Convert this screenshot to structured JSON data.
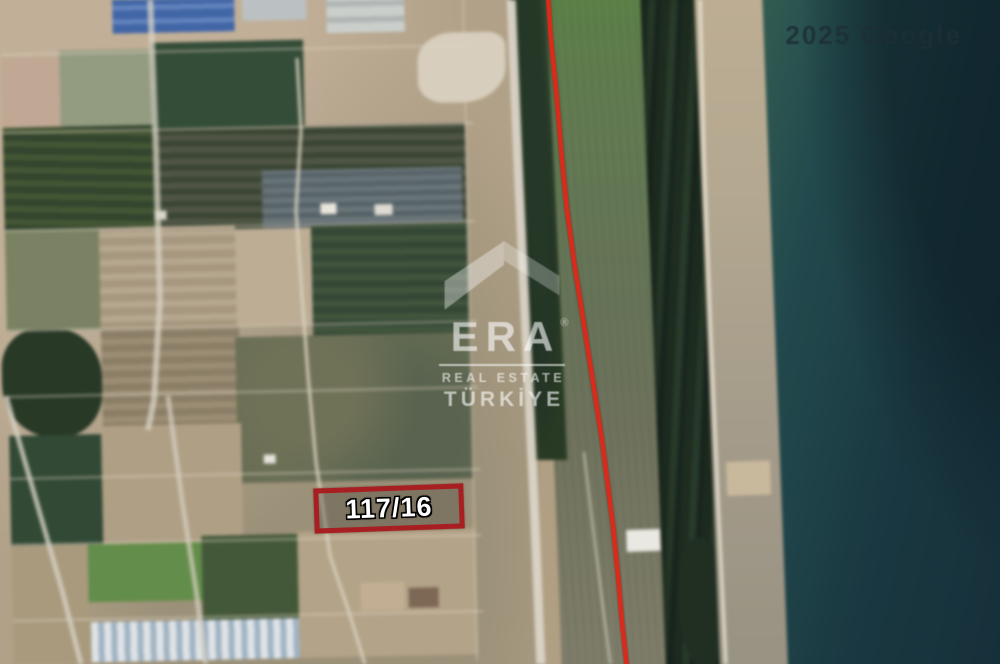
{
  "map": {
    "type": "satellite",
    "attribution": "2025 Google",
    "parcel": {
      "label": "117/16"
    }
  },
  "watermark": {
    "brand": "ERA",
    "registered": "®",
    "tagline": "REAL ESTATE",
    "region": "TÜRKİYE"
  },
  "colors": {
    "boundary_red": "#d92b1c",
    "parcel_red": "#a81f22",
    "parcel_text": "#ffffff",
    "watermark_white": "#ffffff",
    "attribution": "#1d2f36",
    "field_tan": "#b09f83",
    "field_green": "#5a7d46",
    "tree_dark": "#1e2e20",
    "beach_sand": "#b3a68c",
    "sea_shore": "#2c5a4e",
    "sea_deep": "#0f2b36",
    "road_light": "#d5cec0"
  }
}
